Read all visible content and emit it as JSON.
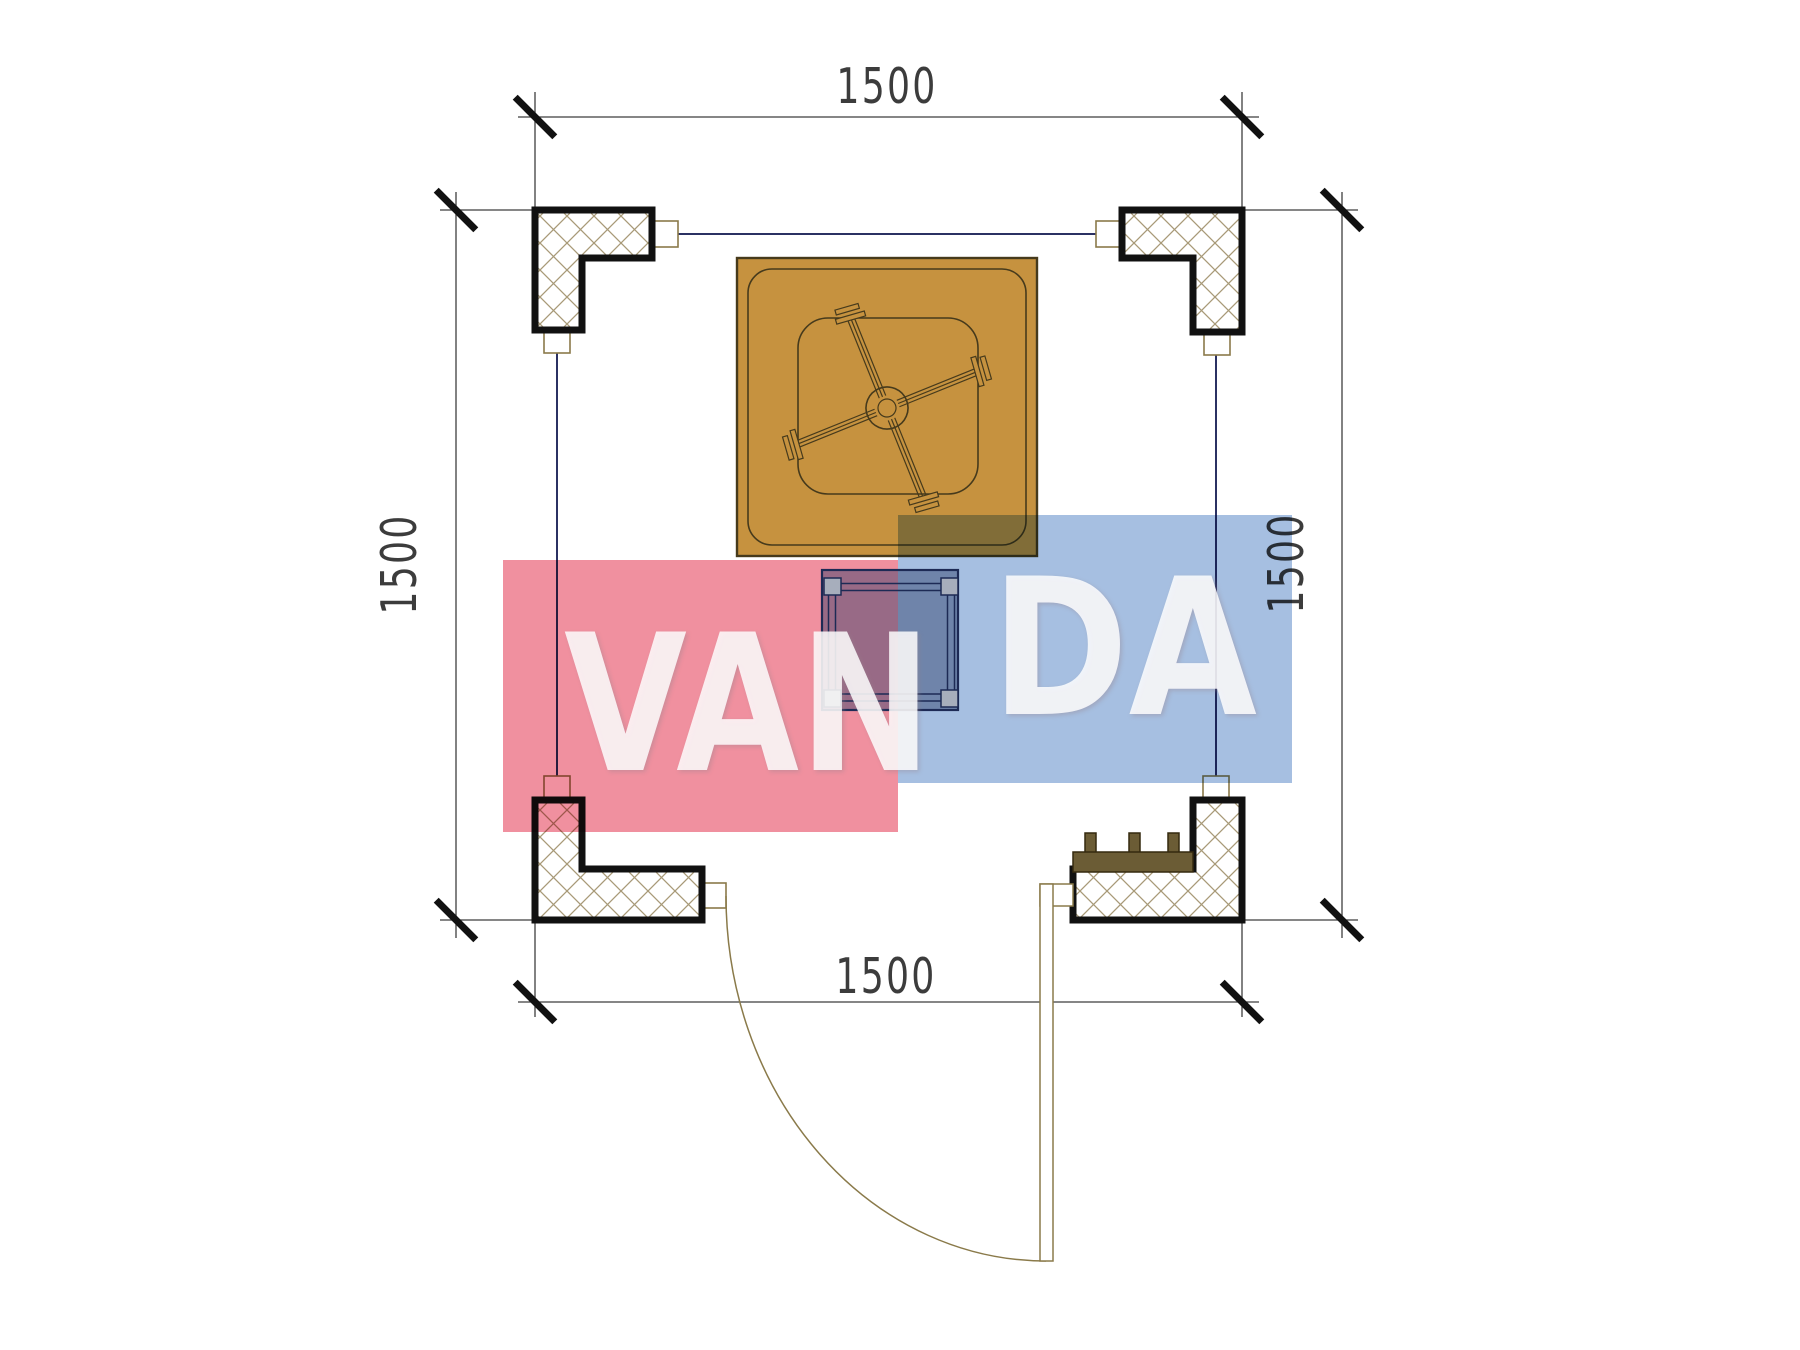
{
  "plan": {
    "title": "gazebo-floor-plan",
    "dimensions": {
      "top_label": "1500",
      "bottom_label": "1500",
      "left_label": "1500",
      "right_label": "1500"
    },
    "watermark": {
      "text_red": "VAN",
      "text_blue": "DA",
      "full_text": "VANDA"
    },
    "colors": {
      "watermark-red": "#f0909f",
      "watermark-blue": "#a6bfe1",
      "umbrella-brown": "#c6923f",
      "outline-dark": "#463a1c",
      "bench-brown": "#6b5c35",
      "navy-line": "#2b3163",
      "dim-line": "#3f3f3f",
      "dim-text": "#3c3c3c",
      "table-navy": "#1d2a55",
      "hatch-line": "#a89a78",
      "door-line": "#8a7a4a",
      "column-border": "#111111"
    }
  }
}
